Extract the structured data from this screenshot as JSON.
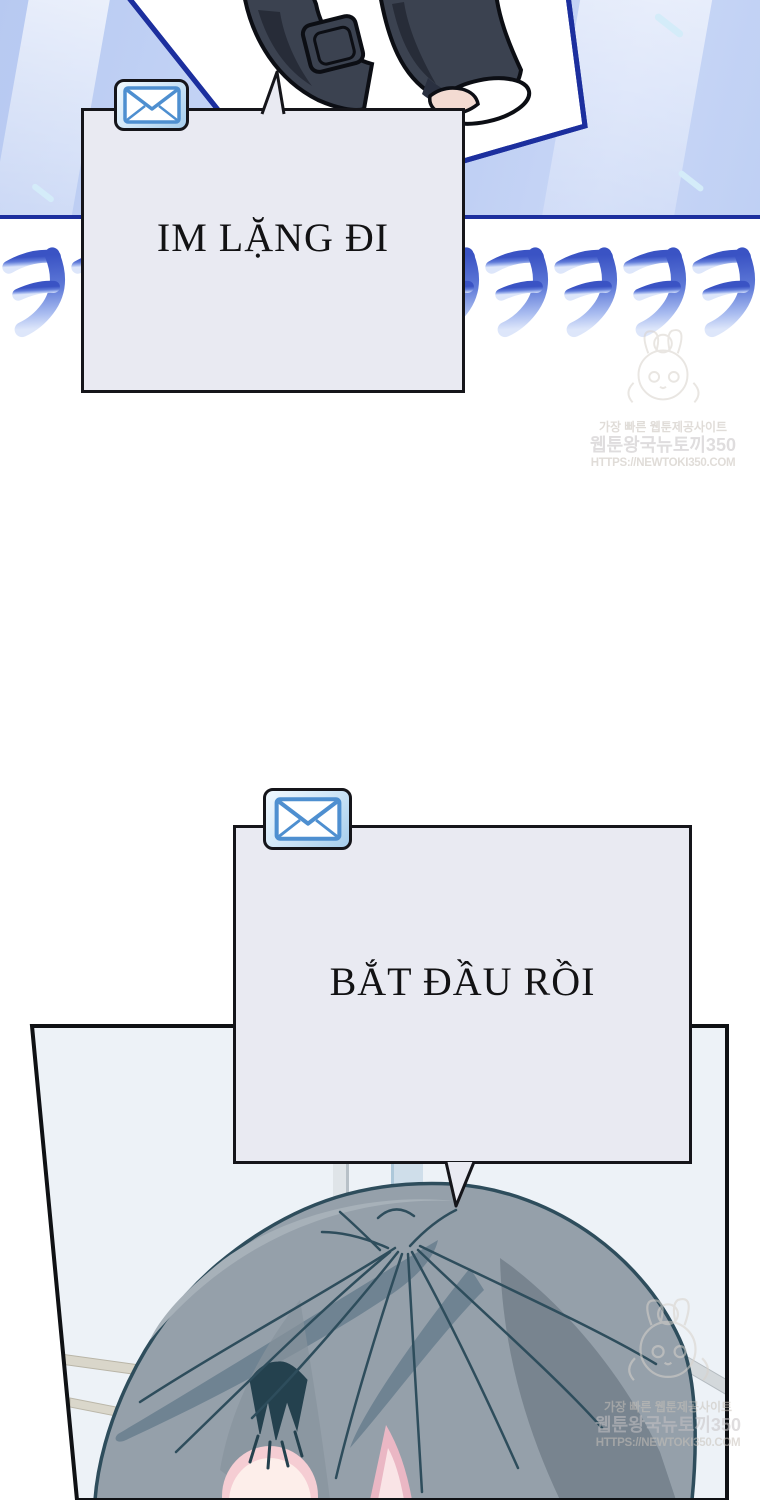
{
  "page_type": "webtoon-comic-page",
  "colors": {
    "sky": "#bccdf3",
    "sky_ray": "#e9effc",
    "panel_frame_navy": "#1c2f9e",
    "photo_card_fill": "#ffffff",
    "pants": "#3b4250",
    "pants_shadow": "#272c38",
    "skin": "#f3dbd2",
    "bubble_fill": "#e9eaf2",
    "bubble_border": "#15151a",
    "laugh_gradient_top": "#3a53c4",
    "laugh_gradient_bottom": "#dde6fa",
    "mail_icon_blue": "#4e8fd0",
    "panel2_bg": "#edf2f7",
    "panel2_border": "#0f1114",
    "hair_base": "#95a0aa",
    "hair_shadow": "#6f8392",
    "hair_outline": "#2e4d5c",
    "forehead_skin": "#fdeeea",
    "blush_pink": "#eab7c4",
    "watermark_gray": "#c7c1b9"
  },
  "laugh": {
    "glyph": "ㅋ",
    "count": 11,
    "pitch": 69
  },
  "bubbles": [
    {
      "text": "IM LẶNG ĐI",
      "badge_icon": "mail-envelope"
    },
    {
      "text": "BẮT ĐẦU RỒI",
      "badge_icon": "mail-envelope"
    }
  ],
  "watermark": {
    "line1": "가장 빠른 웹툰제공사이트",
    "line2": "웹툰왕국뉴토끼350",
    "line3": "HTTPS://NEWTOKI350.COM"
  }
}
